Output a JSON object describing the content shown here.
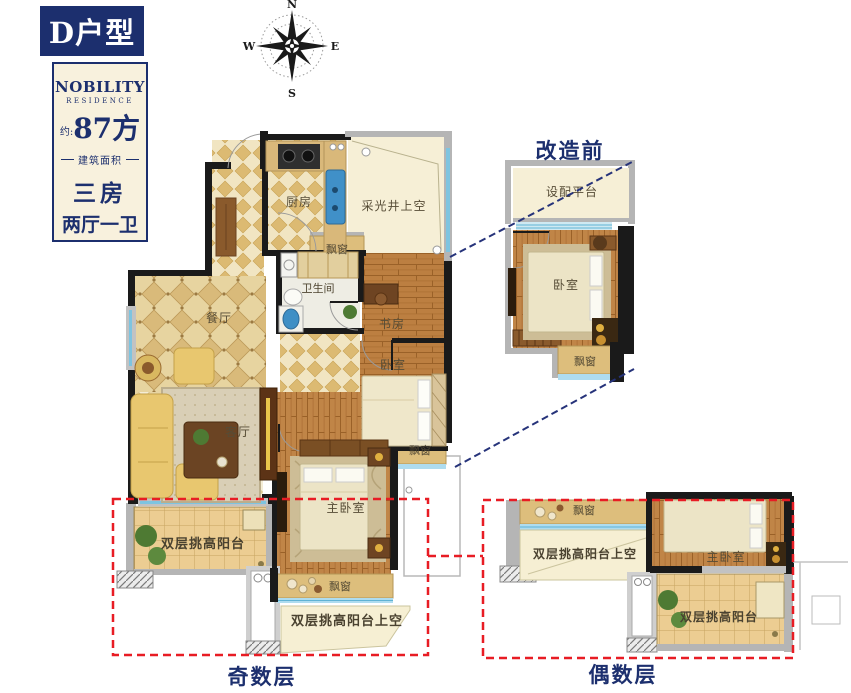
{
  "badge": {
    "label": "D户型"
  },
  "info_card": {
    "brand": "NOBILITY",
    "brand_sub": "RESIDENCE",
    "area_prefix": "约:",
    "area_value": "87方",
    "area_caption": "建筑面积",
    "layout_rooms": "三房",
    "layout_halls": "两厅一卫"
  },
  "compass": {
    "n": "N",
    "e": "E",
    "s": "S",
    "w": "W"
  },
  "captions": {
    "before_renovation": "改造前",
    "odd_floors": "奇数层",
    "even_floors": "偶数层"
  },
  "main_plan": {
    "kitchen": "厨房",
    "light_well": "采光井上空",
    "bay_window_top": "飘窗",
    "bathroom": "卫生间",
    "dining_room": "餐厅",
    "study": "书房",
    "bedroom": "卧室",
    "living_room": "客厅",
    "bay_window_right": "飘窗",
    "master_bedroom": "主卧室",
    "balcony": "双层挑高阳台",
    "bay_window_bottom": "飘窗",
    "balcony_void": "双层挑高阳台上空"
  },
  "before_plan": {
    "equipment_platform": "设配平台",
    "bedroom": "卧室",
    "bay_window": "飘窗"
  },
  "even_plan": {
    "bay_window": "飘窗",
    "balcony_void": "双层挑高阳台上空",
    "master_bedroom": "主卧室",
    "balcony": "双层挑高阳台"
  },
  "colors": {
    "navy": "#1c2f6e",
    "highlight_red": "#e81c24",
    "card_cream": "#f8f1dd",
    "wall_black": "#1a1a1a",
    "window_blue": "#7ec4e0"
  }
}
